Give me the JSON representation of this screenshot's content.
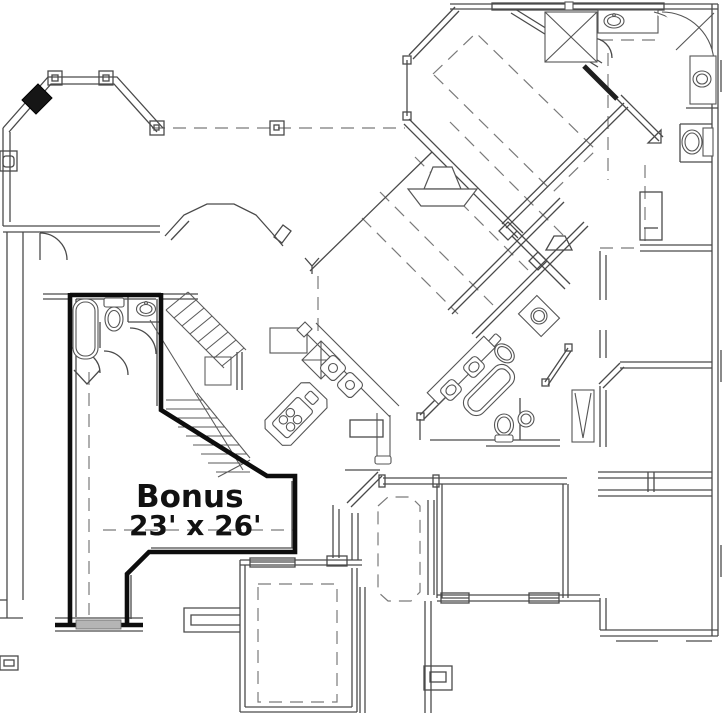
{
  "document": {
    "type": "architectural-floor-plan",
    "title": "House floor plan with bonus room"
  },
  "labels": {
    "bonus_title": "Bonus",
    "bonus_dimensions": "23' x 26'"
  },
  "rooms": [
    {
      "name": "Bonus",
      "dimensions": "23' x 26'",
      "outline": "bold",
      "label_visible": true
    }
  ],
  "icons": [
    "fireplace-icon",
    "bathtub-icon",
    "toilet-icon",
    "sink-icon",
    "shower-icon",
    "corner-tub-icon",
    "cooktop-island-icon",
    "kitchen-sink-icon",
    "stairs-icon",
    "column-icon",
    "linen-shelves-icon"
  ],
  "colors": {
    "paper": "#ffffff",
    "wall": "#4a4a4a",
    "dash": "#7a7a7a",
    "bold": "#0d0d0d",
    "fill-dark": "#161616",
    "fill-gray": "#b5b5b5",
    "text": "#111111"
  }
}
